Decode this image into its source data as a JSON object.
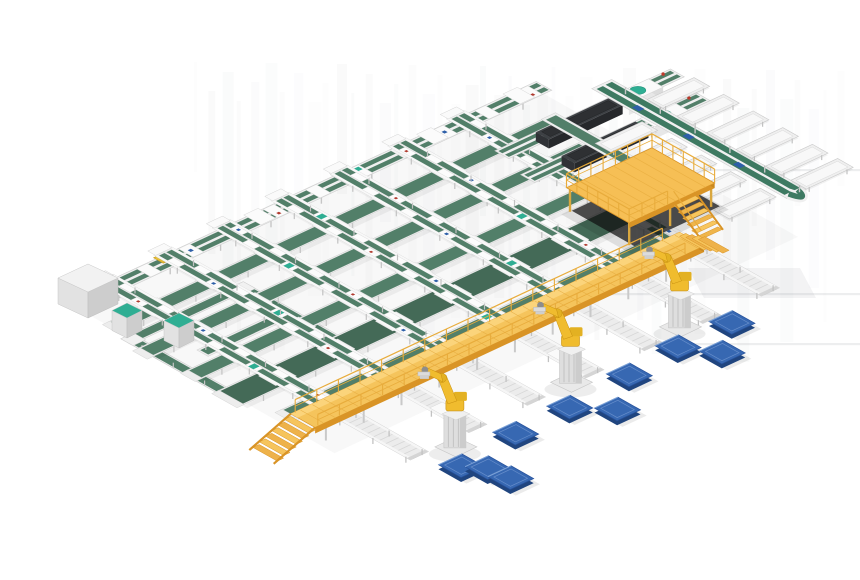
{
  "image": {
    "type": "isometric-3d-render",
    "subject": "Automated parcel sorting and robotic palletizing line",
    "background": "#ffffff"
  },
  "colors": {
    "background": "#ffffff",
    "belt_green": "#527f69",
    "belt_green_dark": "#446a57",
    "sorter_green": "#3e7a62",
    "teal_accent": "#2fae93",
    "frame_white": "#efefef",
    "platform_yellow": "#f5c45c",
    "platform_yellow_light": "#fbd47b",
    "platform_yellow_dark": "#d99426",
    "railing_yellow": "#e8ac3c",
    "robot_yellow": "#f0bc2e",
    "robot_yellow_dark": "#c89010",
    "pallet_blue": "#3768b2",
    "pallet_blue_dark": "#20457f",
    "machine_dark": "#3d4044",
    "cabinet_gray": "#f2f2f2",
    "tote_yellow": "#e8c23a",
    "shadow_gray": "#9aa0a6"
  },
  "conveyor_grid": {
    "top_line": {
      "b": 0,
      "length": 510,
      "tote_a": 84
    },
    "sorter_legs": {
      "count": 7,
      "a_positions": [
        35,
        100,
        165,
        230,
        295,
        360,
        425
      ],
      "b_start": -14,
      "b_end": 250
    },
    "cross_belts": [
      {
        "b": 45,
        "w": 14,
        "a0": -10,
        "a1": 480
      },
      {
        "b": 90,
        "w": 14,
        "a0": -20,
        "a1": 470
      },
      {
        "b": 140,
        "w": 14,
        "a0": -15,
        "a1": 445
      },
      {
        "b": 185,
        "w": 26,
        "a0": -18,
        "a1": 432
      },
      {
        "b": 232,
        "w": 12,
        "a0": 0,
        "a1": 418
      }
    ]
  },
  "west_section": {
    "loop_ring": {
      "a0": -20,
      "b0": 62,
      "a_len": 136,
      "b_len": 120
    },
    "gray_cabinet": {
      "x": 58,
      "y": 264
    },
    "teal_cabinets": [
      {
        "x": 112,
        "y": 303
      },
      {
        "x": 164,
        "y": 313
      }
    ]
  },
  "north_section": {
    "machines": [
      {
        "a": 455,
        "b": 55
      },
      {
        "a": 445,
        "b": 95
      }
    ],
    "mezzanine": {
      "a": 390,
      "b": 150,
      "width": 95,
      "depth": 72,
      "height": 22
    }
  },
  "sorter_loop": {
    "a_center": 547,
    "b_range": [
      28,
      252
    ],
    "parcels_b": [
      70,
      128,
      186
    ],
    "spur_tables_upper": {
      "a": 558,
      "b_positions": [
        78,
        112,
        146,
        180,
        214,
        243
      ]
    },
    "spur_tables_lower": {
      "a": 479,
      "b_positions": [
        100,
        134,
        168,
        202,
        236
      ]
    },
    "feeder": {
      "a": 472,
      "b0": 36,
      "b1": 152
    }
  },
  "palletizing": {
    "platform": {
      "a_range": [
        -15,
        417
      ],
      "b": 252,
      "depth": 28,
      "height": 16
    },
    "outfeed_lanes": {
      "a_positions": [
        35,
        100,
        165,
        230,
        295,
        360,
        425
      ],
      "b0": 248,
      "b1": 348
    }
  },
  "robots": {
    "count": 3,
    "positions": [
      {
        "a": 63,
        "b": 360
      },
      {
        "a": 203,
        "b": 348
      },
      {
        "a": 329,
        "b": 343
      }
    ]
  },
  "pallets": {
    "count": 10,
    "positions": [
      {
        "a": 356,
        "b": 349
      },
      {
        "a": 297,
        "b": 348
      },
      {
        "a": 318,
        "b": 377
      },
      {
        "a": 237,
        "b": 354
      },
      {
        "a": 166,
        "b": 359
      },
      {
        "a": 193,
        "b": 386
      },
      {
        "a": 105,
        "b": 360
      },
      {
        "a": 37,
        "b": 368
      },
      {
        "a": 51,
        "b": 384
      },
      {
        "a": 54,
        "b": 407
      }
    ]
  },
  "render_artifacts": {
    "horizontal_lines": [
      [
        690,
        860,
        169
      ],
      [
        600,
        860,
        293
      ],
      [
        640,
        860,
        343
      ]
    ],
    "vertical_streak_region": [
      194,
      62,
      850,
      300
    ]
  }
}
